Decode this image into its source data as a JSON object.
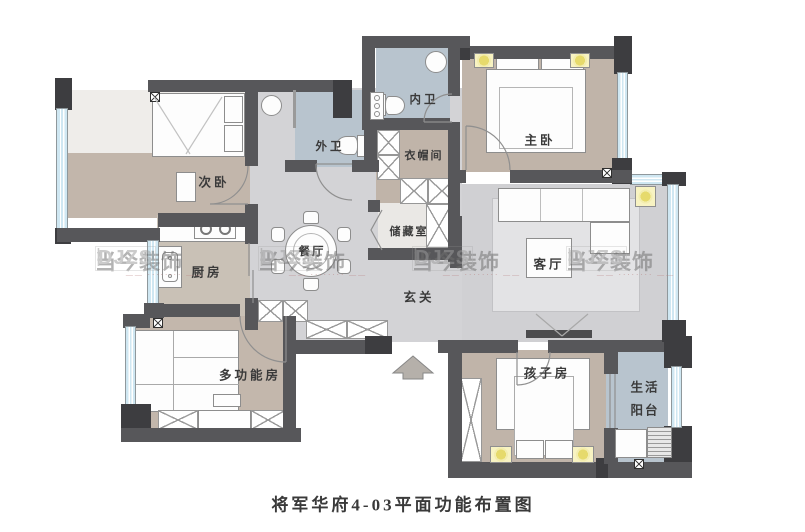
{
  "caption": "将军华府4-03平面功能布置图",
  "watermark": {
    "brand": "当今装饰",
    "divider": "|",
    "latin": "DJZS",
    "tagline": "—— ········ ——"
  },
  "rooms": {
    "ciwo": "次卧",
    "chufang": "厨房",
    "canting": "餐厅",
    "waiwei": "外卫",
    "neiwei": "内卫",
    "yimaojian": "衣帽间",
    "chucangshi": "储藏室",
    "zhuwo": "主卧",
    "keting": "客厅",
    "xuanguan": "玄关",
    "duogongnengfang": "多功能房",
    "haizifang": "孩子房",
    "shenghuo": "生活",
    "yangtai": "阳台"
  },
  "colors": {
    "wall": "#57575a",
    "floor_hall": "#d3d3d6",
    "floor_bedroom": "#c0b4a9",
    "floor_bath": "#b8c4ce",
    "window": "#cfe7f2",
    "ceiling_light": "#f3edaf"
  }
}
